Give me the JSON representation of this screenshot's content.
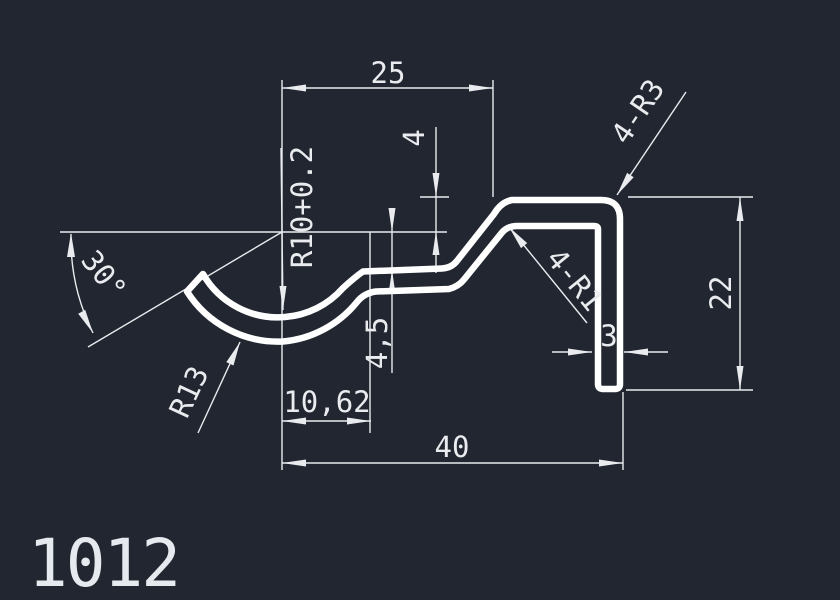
{
  "drawing": {
    "part_number": "1012",
    "colors": {
      "background": "#212630",
      "profile_line": "#ffffff",
      "dimension_line": "#e9ebee"
    },
    "labels": {
      "width_top": "25",
      "flange_offset": "4",
      "corner_radius_outer": "4-R3",
      "arc_radius_inner": "R10+0.2",
      "angle": "30°",
      "height_right": "22",
      "web_offset": "4,5",
      "arc_radius_outer": "R13",
      "trough_offset": "10,62",
      "leg_thickness": "3",
      "total_width": "40",
      "corner_radius_inner": "4-R1"
    }
  }
}
